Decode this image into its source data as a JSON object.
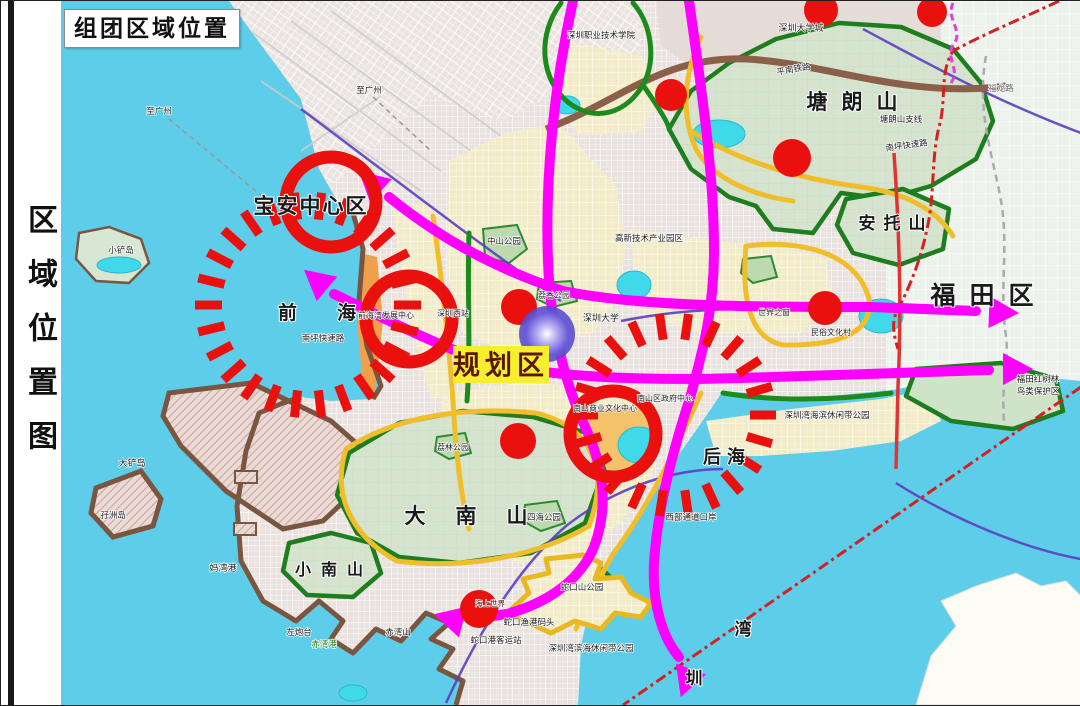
{
  "page": {
    "frame_title": "组团区域位置",
    "sidebar_label": "区域位置图"
  },
  "planning_box": {
    "label": "规划区",
    "x": 452,
    "y": 345,
    "w": 96,
    "h": 37,
    "bg": "#f7ef2d",
    "color": "#5c1608"
  },
  "colors": {
    "water": "#5ecde9",
    "marker_red": "#ea100e",
    "road_magenta": "#ff00ff",
    "road_yellow": "#f0be2a",
    "road_green": "#1d8a1d",
    "boundary_red": "#d42020"
  },
  "glow": {
    "x": 546,
    "y": 333,
    "r": 28
  },
  "red_dots": [
    {
      "x": 670,
      "y": 94,
      "r": 16
    },
    {
      "x": 791,
      "y": 157,
      "r": 19
    },
    {
      "x": 820,
      "y": 9,
      "r": 17
    },
    {
      "x": 931,
      "y": 11,
      "r": 15
    },
    {
      "x": 518,
      "y": 306,
      "r": 18
    },
    {
      "x": 517,
      "y": 440,
      "r": 18
    },
    {
      "x": 478,
      "y": 608,
      "r": 19
    },
    {
      "x": 824,
      "y": 307,
      "r": 17
    }
  ],
  "red_rings": [
    {
      "x": 330,
      "y": 201,
      "r": 45,
      "w": 13
    },
    {
      "x": 408,
      "y": 318,
      "r": 43,
      "w": 13
    },
    {
      "x": 612,
      "y": 433,
      "r": 43,
      "w": 13
    }
  ],
  "tick_circles": [
    {
      "x": 307,
      "y": 304,
      "r": 86,
      "len": 27,
      "count": 26,
      "w": 9
    },
    {
      "x": 673,
      "y": 414,
      "r": 76,
      "len": 26,
      "count": 22,
      "w": 9
    }
  ],
  "labels": [
    {
      "t": "宝安中心区",
      "x": 310,
      "y": 212,
      "s": 21,
      "b": 1,
      "ls": 2
    },
    {
      "t": "前海",
      "x": 336,
      "y": 318,
      "s": 19,
      "ls": 40,
      "b": 1
    },
    {
      "t": "大南山",
      "x": 480,
      "y": 522,
      "s": 21,
      "ls": 30,
      "b": 1
    },
    {
      "t": "小南山",
      "x": 333,
      "y": 574,
      "s": 16,
      "ls": 10,
      "b": 1
    },
    {
      "t": "塘朗山",
      "x": 858,
      "y": 108,
      "s": 21,
      "ls": 14,
      "b": 1
    },
    {
      "t": "安托山",
      "x": 895,
      "y": 228,
      "s": 17,
      "ls": 8,
      "b": 1
    },
    {
      "t": "福田区",
      "x": 988,
      "y": 303,
      "s": 25,
      "ls": 14,
      "b": 1
    },
    {
      "t": "后海",
      "x": 726,
      "y": 462,
      "s": 18,
      "ls": 6,
      "b": 1
    },
    {
      "t": "湾",
      "x": 742,
      "y": 634,
      "s": 17,
      "b": 1
    },
    {
      "t": "圳",
      "x": 693,
      "y": 683,
      "s": 17,
      "b": 1
    },
    {
      "t": "深圳大学",
      "x": 600,
      "y": 320,
      "s": 9,
      "sm": 1
    },
    {
      "t": "高新技术产业园区",
      "x": 648,
      "y": 240,
      "s": 8.5,
      "sm": 1
    },
    {
      "t": "中山公园",
      "x": 503,
      "y": 243,
      "s": 8.5,
      "sm": 1
    },
    {
      "t": "深圳大学城",
      "x": 800,
      "y": 30,
      "s": 9,
      "sm": 1
    },
    {
      "t": "深圳职业技术学院",
      "x": 600,
      "y": 37,
      "s": 8.5,
      "sm": 1
    },
    {
      "t": "南坪快速路",
      "x": 906,
      "y": 147,
      "s": 8.5,
      "r": -8,
      "sm": 1
    },
    {
      "t": "南坪快速路",
      "x": 322,
      "y": 340,
      "s": 8.5,
      "sm": 1
    },
    {
      "t": "平南铁路",
      "x": 793,
      "y": 71,
      "s": 8.5,
      "r": -10,
      "sm": 1
    },
    {
      "t": "塘朗山支线",
      "x": 900,
      "y": 121,
      "s": 8.5,
      "sm": 1
    },
    {
      "t": "福龙路",
      "x": 1000,
      "y": 90,
      "s": 8.5,
      "c": "#666666",
      "sm": 1
    },
    {
      "t": "妈湾港",
      "x": 222,
      "y": 570,
      "s": 9,
      "sm": 1
    },
    {
      "t": "大铲岛",
      "x": 131,
      "y": 465,
      "s": 9,
      "sm": 1
    },
    {
      "t": "孖洲岛",
      "x": 112,
      "y": 517,
      "s": 8.5,
      "sm": 1
    },
    {
      "t": "小铲岛",
      "x": 120,
      "y": 252,
      "s": 8.5,
      "sm": 1
    },
    {
      "t": "蛇口渔港码头",
      "x": 528,
      "y": 624,
      "s": 8.5,
      "sm": 1
    },
    {
      "t": "蛇口港客运站",
      "x": 495,
      "y": 642,
      "s": 8.5,
      "sm": 1
    },
    {
      "t": "深圳湾海滨休闲带公园",
      "x": 826,
      "y": 417,
      "s": 8.5,
      "sm": 1
    },
    {
      "t": "深圳湾滨海休闲带公园",
      "x": 590,
      "y": 650,
      "s": 8.5,
      "sm": 1
    },
    {
      "t": "西部通道口岸",
      "x": 690,
      "y": 519,
      "s": 8.5,
      "sm": 1
    },
    {
      "t": "福田红树林",
      "x": 1037,
      "y": 381,
      "s": 8.5,
      "sm": 1
    },
    {
      "t": "鸟类保护区",
      "x": 1037,
      "y": 393,
      "s": 8.5,
      "sm": 1
    },
    {
      "t": "南山区政府中心",
      "x": 664,
      "y": 400,
      "s": 8,
      "sm": 1
    },
    {
      "t": "南山商业文化中心",
      "x": 604,
      "y": 410,
      "s": 8,
      "sm": 1
    },
    {
      "t": "前海湾发展中心",
      "x": 385,
      "y": 317,
      "s": 8,
      "sm": 1
    },
    {
      "t": "深圳西站",
      "x": 452,
      "y": 315,
      "s": 8,
      "sm": 1
    },
    {
      "t": "荔香公园",
      "x": 553,
      "y": 297,
      "s": 8,
      "sm": 1
    },
    {
      "t": "四海公园",
      "x": 543,
      "y": 519,
      "s": 8.5,
      "sm": 1
    },
    {
      "t": "荔林公园",
      "x": 452,
      "y": 449,
      "s": 8,
      "sm": 1
    },
    {
      "t": "蛇口山公园",
      "x": 581,
      "y": 589,
      "s": 8.5,
      "sm": 1
    },
    {
      "t": "赤湾山",
      "x": 397,
      "y": 634,
      "s": 8.5,
      "sm": 1
    },
    {
      "t": "左炮台",
      "x": 298,
      "y": 634,
      "s": 8.5,
      "sm": 1
    },
    {
      "t": "赤湾港",
      "x": 323,
      "y": 646,
      "s": 8.5,
      "c": "#1a7a1a",
      "sm": 1
    },
    {
      "t": "海上世界",
      "x": 489,
      "y": 605,
      "s": 7.5,
      "c": "#4a0808",
      "sm": 1
    },
    {
      "t": "世界之窗",
      "x": 773,
      "y": 314,
      "s": 8,
      "sm": 1
    },
    {
      "t": "民俗文化村",
      "x": 830,
      "y": 334,
      "s": 8,
      "sm": 1
    },
    {
      "t": "至广州",
      "x": 158,
      "y": 113,
      "s": 8.5,
      "sm": 1
    },
    {
      "t": "至广州",
      "x": 368,
      "y": 92,
      "s": 8.5,
      "sm": 1
    }
  ]
}
